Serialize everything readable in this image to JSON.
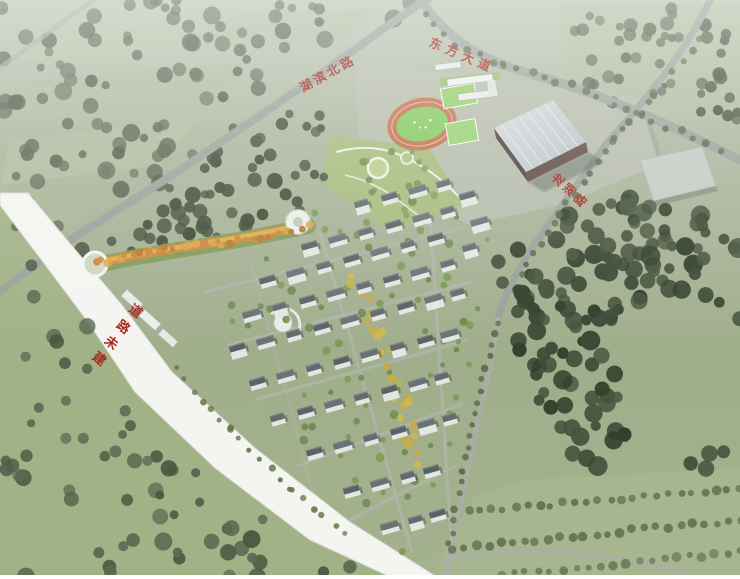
{
  "road_labels": [
    {
      "id": "north-road",
      "text": "湖滨北路"
    },
    {
      "id": "avenue",
      "text": "东方大道"
    },
    {
      "id": "east-road",
      "text": "龙湖路"
    },
    {
      "id": "unbuilt-road",
      "text": "道路未建"
    }
  ],
  "colors": {
    "label_red": "#a62a20",
    "white_road": "#f4f5f1",
    "road_gray": "#9aa29b",
    "track_orange": "#c4714d",
    "infield_green": "#85ca5f",
    "court_green": "#92cf67",
    "field_light": "#aab79a",
    "forest_dark": "#3c4935",
    "ridge_orange": "#cd8d3e",
    "building_roof": "#646b6e",
    "building_wall": "#e3e7e4",
    "gym_roof": "#ccd3d7",
    "gym_wall": "#5f4b44"
  }
}
